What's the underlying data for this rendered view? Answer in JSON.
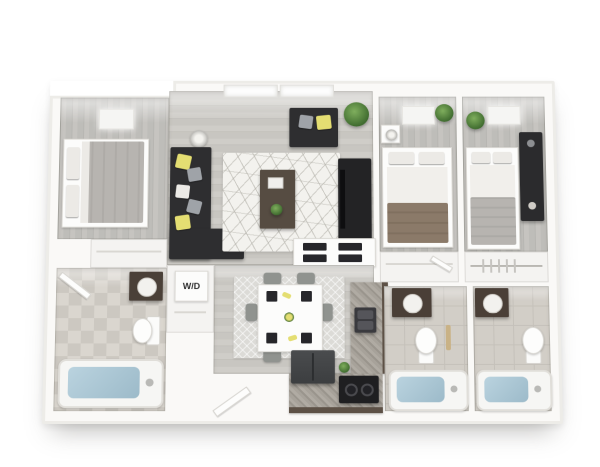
{
  "labels": {
    "mech_closet": "Mech.",
    "washer_dryer": "W/D"
  },
  "palette": {
    "background": "#ffffff",
    "walls": "#faf9f7",
    "wood_floor_living": "#cbc9c4",
    "wood_floor_bedroom": "#bfbeba",
    "bath_tile": "#d2cec7",
    "sofa_charcoal": "#2e2e30",
    "accent_yellow": "#e4de72",
    "kitchen_cabinet_brown": "#5d5146",
    "granite_counter": "#a39e96",
    "tub_water": "#aec9d8",
    "plant_green": "#4e7d3a",
    "rug_white": "#f3f2ee",
    "bed_blanket_brown": "#8b7a69",
    "bed_blanket_gray": "#b7b4b0"
  }
}
